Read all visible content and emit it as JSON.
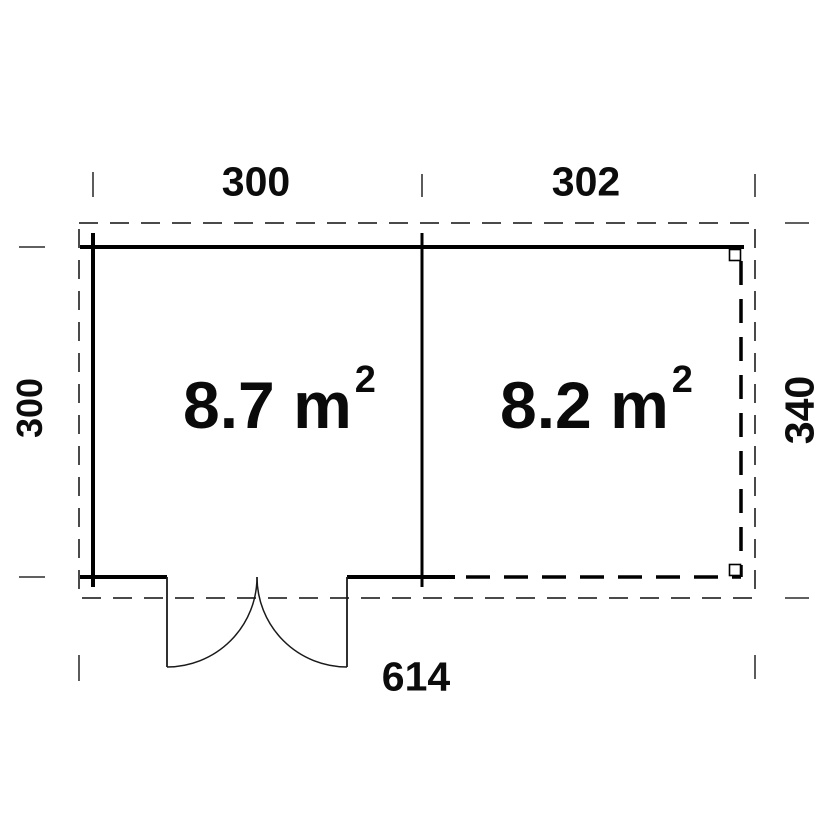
{
  "floor_plan": {
    "dimensions": {
      "top_left_width": "300",
      "top_right_width": "302",
      "left_height": "300",
      "right_height": "340",
      "bottom_total_width": "614"
    },
    "rooms": {
      "left": {
        "area_main": "8.7 m",
        "area_sup": "2"
      },
      "right": {
        "area_main": "8.2 m",
        "area_sup": "2"
      }
    },
    "colors": {
      "wall_line": "#000000",
      "door_line": "#1a1a1a",
      "dashed_outline": "#4a4a4a",
      "background": "#ffffff"
    }
  }
}
